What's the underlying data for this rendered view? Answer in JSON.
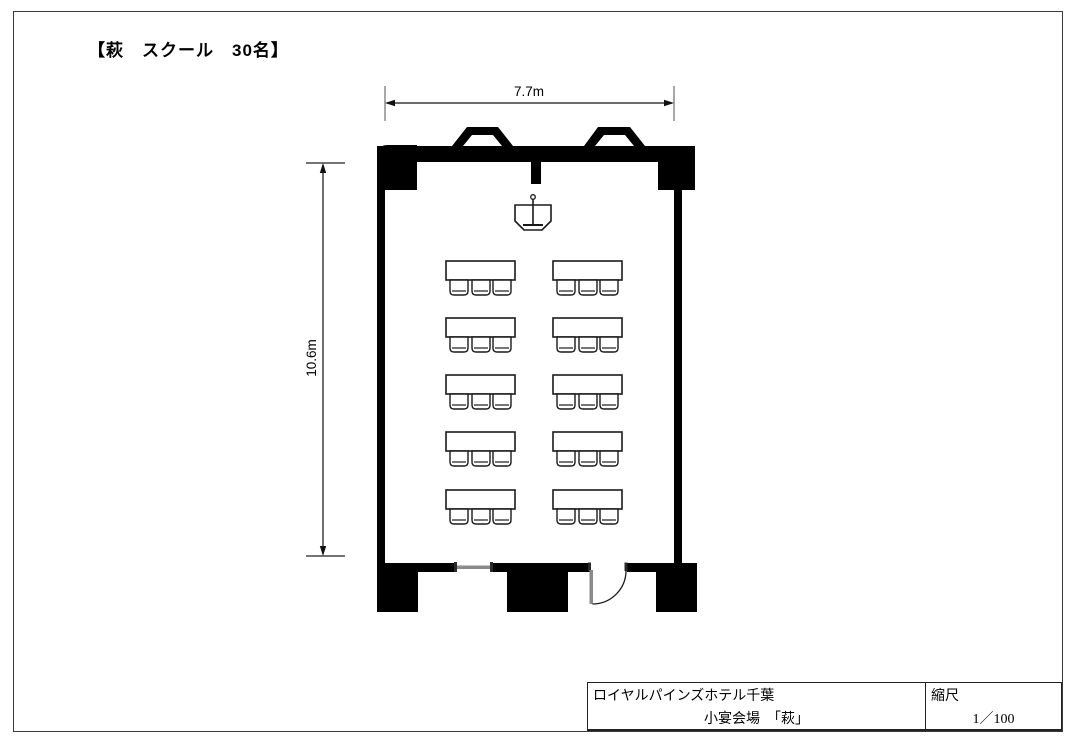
{
  "page_title": "【萩　スクール　30名】",
  "dimensions": {
    "width": "7.7m",
    "height": "10.6m"
  },
  "title_block": {
    "hotel": "ロイヤルパインズホテル千葉",
    "room": "小宴会場　「萩」",
    "scale_label": "縮尺",
    "scale_value": "1／100"
  },
  "floor_plan": {
    "colors": {
      "wall": "#000000",
      "line": "#1a1a1a",
      "door": "#8a8a8a"
    },
    "furniture": {
      "podium": "lectern-with-microphone",
      "table_grid": {
        "column_x": [
          446,
          553
        ],
        "row_y": [
          261,
          318,
          375,
          432,
          490
        ],
        "table_width": 69,
        "table_height": 19,
        "chair_offsets": [
          4,
          26,
          47
        ],
        "chair_width": 18,
        "chair_height": 15
      }
    }
  }
}
